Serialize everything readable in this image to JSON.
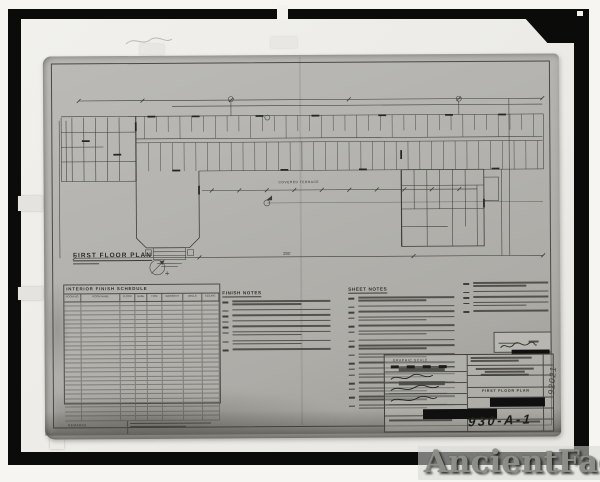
{
  "watermark_text": "AncientFaces",
  "annotations": {
    "sheet_number": "930-A-1",
    "margin_code": "92021"
  },
  "plan": {
    "label": "FIRST FLOOR PLAN",
    "terrace_label": "COVERED TERRACE",
    "total_dim": "255'"
  },
  "schedule": {
    "title": "INTERIOR FINISH SCHEDULE",
    "columns": [
      "ROOM NO.",
      "ROOM NAME",
      "FLOOR",
      "BASE",
      "TRIM",
      "WAINSCOT",
      "WALLS",
      "CEILING"
    ],
    "row_count": 27,
    "footer_label": "REMARKS"
  },
  "finish_notes": {
    "heading": "FINISH NOTES",
    "item_line_counts": [
      2,
      1,
      1,
      1,
      1,
      2,
      2,
      1
    ]
  },
  "sheet_notes": {
    "heading": "SHEET NOTES",
    "item_line_counts": [
      2,
      1,
      1,
      2,
      1,
      2,
      1,
      2,
      2,
      1,
      1,
      2,
      1,
      2,
      2,
      2
    ],
    "highlight_items": [
      11,
      13
    ],
    "col2_line_counts": [
      2,
      1,
      1,
      2,
      1
    ]
  },
  "title_block": {
    "graphic_scale_label": "GRAPHIC SCALE",
    "drawing_title": "FIRST FLOOR PLAN"
  }
}
